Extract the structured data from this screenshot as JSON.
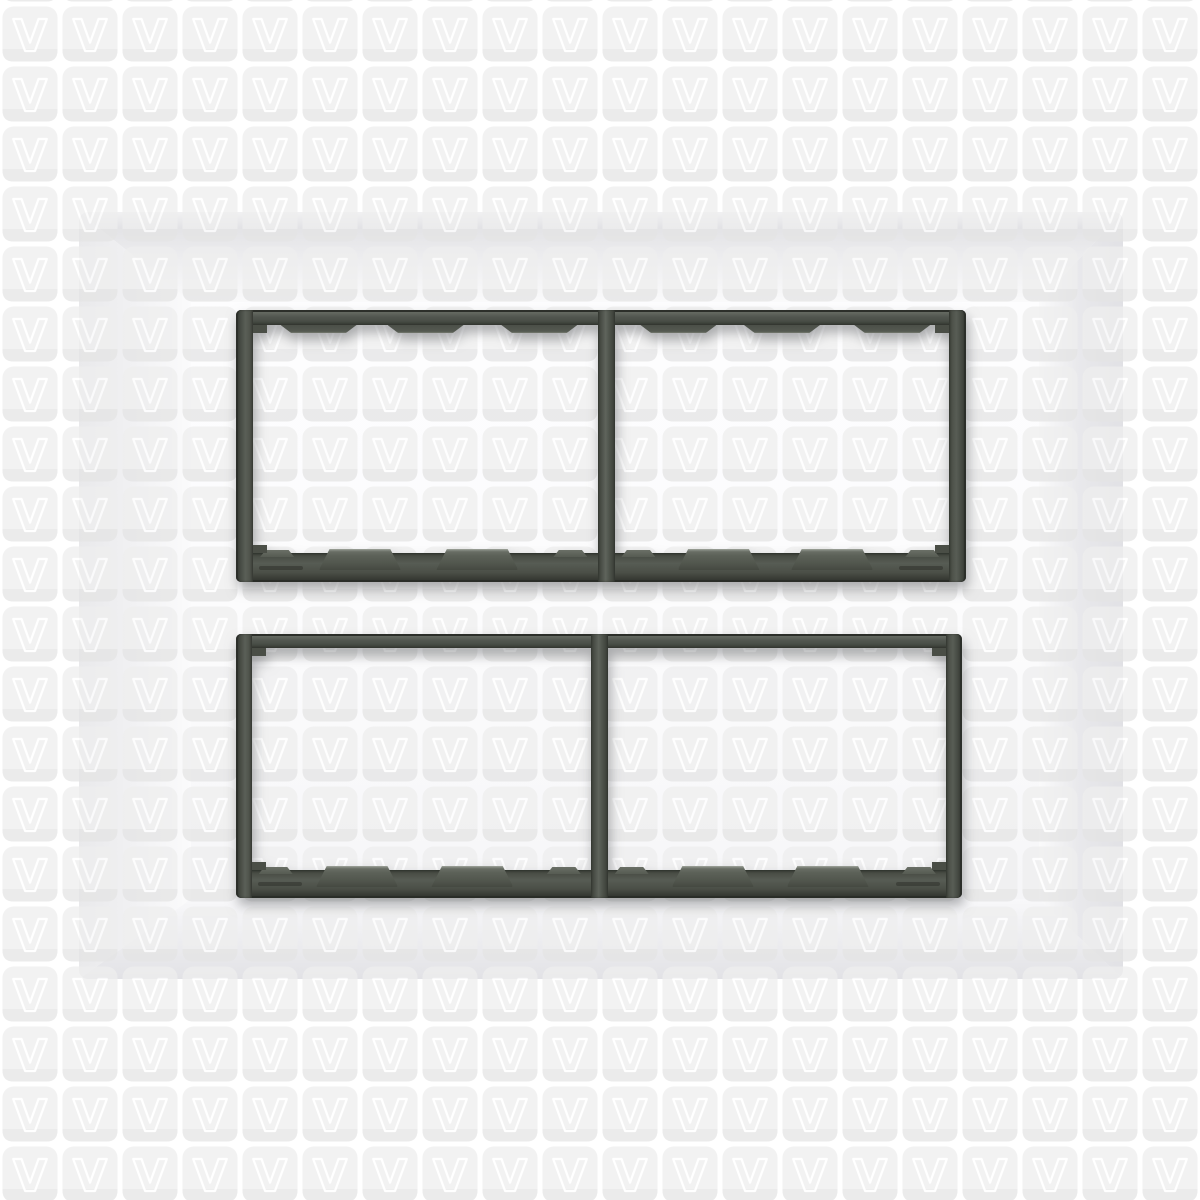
{
  "scene": {
    "description": "White modular electrical switch plate with two dark grey twin-window module frames, photographed over a tiled V-logo watermark background"
  },
  "watermark": {
    "glyph": "V",
    "tile_fill": "#eeeeee",
    "tile_band_fill": "#e4e4e4",
    "glyph_stroke": "#ffffff",
    "columns": 20,
    "rows": 20
  },
  "plate": {
    "face_color": "#fcfcfd",
    "bevel_edge_color": "#e7e7ea"
  },
  "module_frames": {
    "count": 2,
    "windows_per_frame": 2,
    "body_color": "#4e534d",
    "outline_color": "#2c2f2a",
    "clip_pad_color": "#5d6259",
    "clip_pads_per_window": 2,
    "small_tabs_per_window": 2,
    "top_tabs_per_window_on_top_frame": 3
  }
}
